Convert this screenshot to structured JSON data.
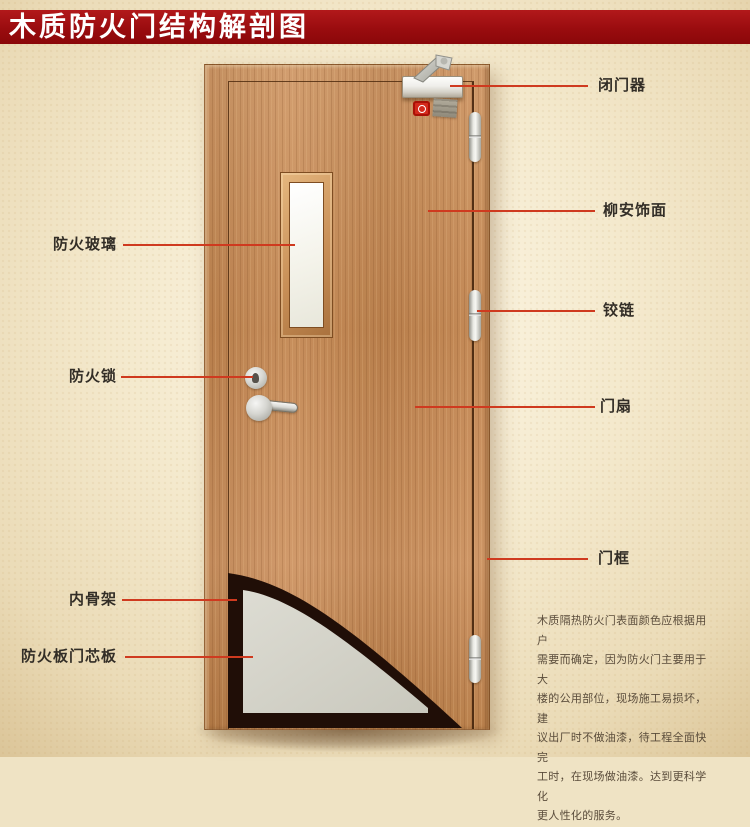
{
  "banner": {
    "title": "木质防火门结构解剖图",
    "bg_color": "#9a0c0f",
    "text_color": "#ffffff"
  },
  "colors": {
    "callout_line": "#cf3a1f",
    "background": "#f2e7cb",
    "wood": "#c78e5c",
    "fire_board_core": "#d3d2c8",
    "inner_skeleton": "#200e07"
  },
  "labels": {
    "right": [
      {
        "id": "door-closer",
        "text": "闭门器"
      },
      {
        "id": "lauan-veneer",
        "text": "柳安饰面"
      },
      {
        "id": "hinge",
        "text": "铰链"
      },
      {
        "id": "door-leaf",
        "text": "门扇"
      },
      {
        "id": "door-frame",
        "text": "门框"
      }
    ],
    "left": [
      {
        "id": "fire-glass",
        "text": "防火玻璃"
      },
      {
        "id": "fire-lock",
        "text": "防火锁"
      },
      {
        "id": "inner-skeleton",
        "text": "内骨架"
      },
      {
        "id": "fire-board-core",
        "text": "防火板门芯板"
      }
    ]
  },
  "description": "木质隔热防火门表面颜色应根据用户\n需要而确定，因为防火门主要用于大\n楼的公用部位，现场施工易损坏，建\n议出厂时不做油漆，待工程全面快完\n工时，在现场做油漆。达到更科学化\n更人性化的服务。"
}
